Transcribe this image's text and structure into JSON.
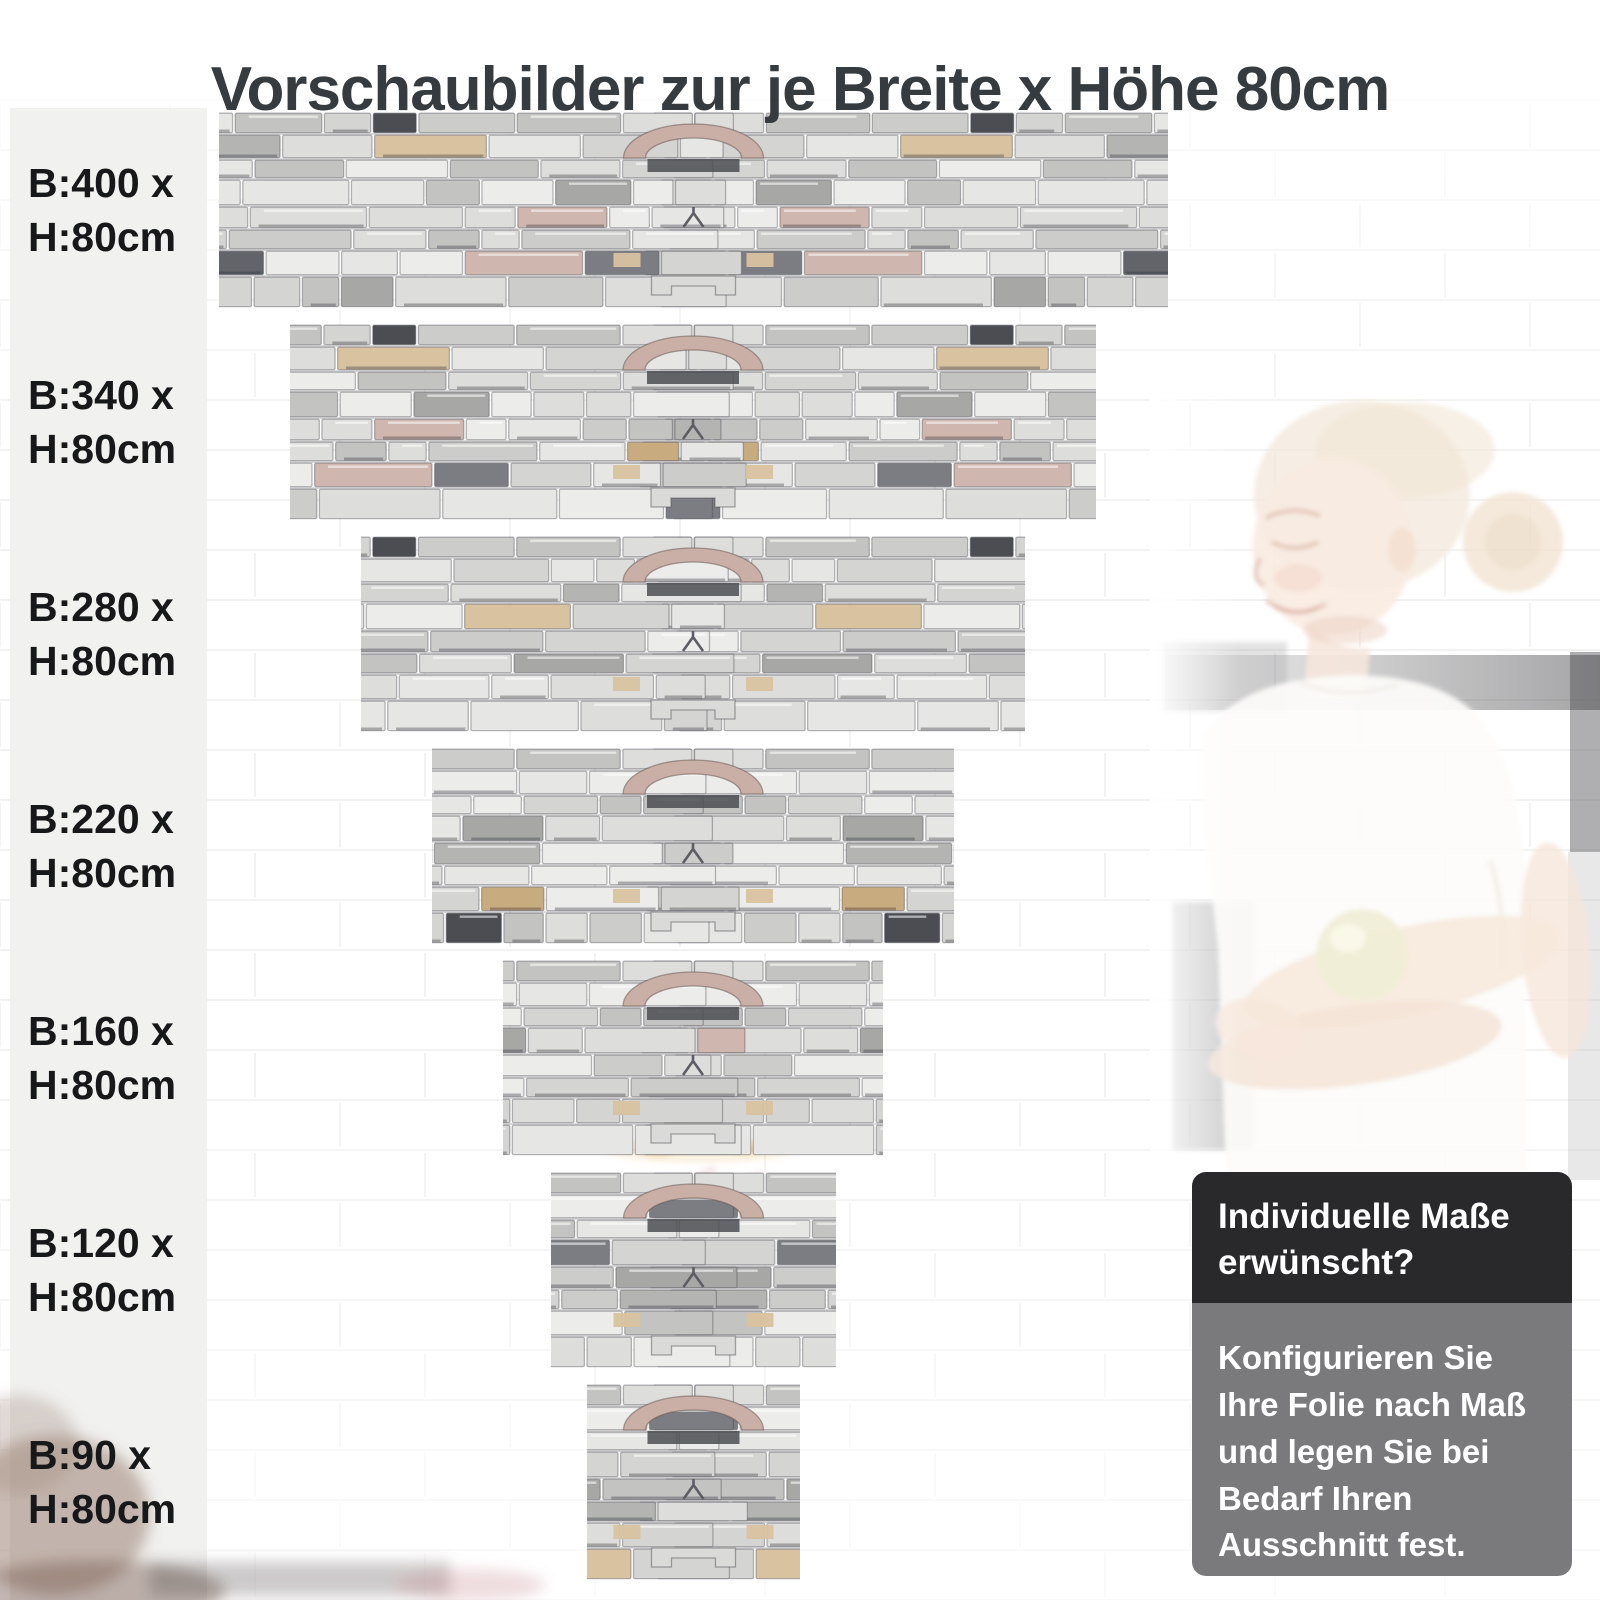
{
  "title": "Vorschaubilder zur je Breite x Höhe 80cm",
  "sizes": [
    {
      "width_cm": 400,
      "height_cm": 80,
      "line1": "B:400 x",
      "line2": "H:80cm"
    },
    {
      "width_cm": 340,
      "height_cm": 80,
      "line1": "B:340 x",
      "line2": "H:80cm"
    },
    {
      "width_cm": 280,
      "height_cm": 80,
      "line1": "B:280 x",
      "line2": "H:80cm"
    },
    {
      "width_cm": 220,
      "height_cm": 80,
      "line1": "B:220 x",
      "line2": "H:80cm"
    },
    {
      "width_cm": 160,
      "height_cm": 80,
      "line1": "B:160 x",
      "line2": "H:80cm"
    },
    {
      "width_cm": 120,
      "height_cm": 80,
      "line1": "B:120 x",
      "line2": "H:80cm"
    },
    {
      "width_cm": 90,
      "height_cm": 80,
      "line1": "B:90 x",
      "line2": "H:80cm"
    }
  ],
  "info_box": {
    "heading": "Individuelle Maße\nerwünscht?",
    "body": "Konfigurieren Sie\nIhre Folie nach Maß\nund legen Sie bei\nBedarf Ihren\nAusschnitt fest."
  },
  "colors": {
    "title_text": "#363b40",
    "label_text": "#17181a",
    "label_column_bg": "#f1f1ef",
    "info_header_bg": "#29292b",
    "info_body_bg": "#7a7a7c",
    "info_text": "#ffffff",
    "brick_line": "#ebebe9"
  },
  "stone": {
    "arch_pink": "#c9afa6",
    "accent_dark": "#4b4d52",
    "accent_tan": "#d8c2a0",
    "palette": [
      {
        "color": "#e6e6e4",
        "w": 10
      },
      {
        "color": "#dddddb",
        "w": 12
      },
      {
        "color": "#d4d4d2",
        "w": 10
      },
      {
        "color": "#cccccb",
        "w": 7
      },
      {
        "color": "#c3c4c2",
        "w": 5
      },
      {
        "color": "#ececea",
        "w": 6
      },
      {
        "color": "#b4b5b3",
        "w": 3
      },
      {
        "color": "#a7a8a6",
        "w": 2
      },
      {
        "color": "#62646a",
        "w": 1.4
      },
      {
        "color": "#4b4d52",
        "w": 0.9
      },
      {
        "color": "#7b7d82",
        "w": 1.2
      },
      {
        "color": "#d8c2a0",
        "w": 1.1
      },
      {
        "color": "#c9ab80",
        "w": 0.7
      },
      {
        "color": "#e0d2b6",
        "w": 0.9
      },
      {
        "color": "#cfb6ae",
        "w": 0.6
      }
    ]
  }
}
